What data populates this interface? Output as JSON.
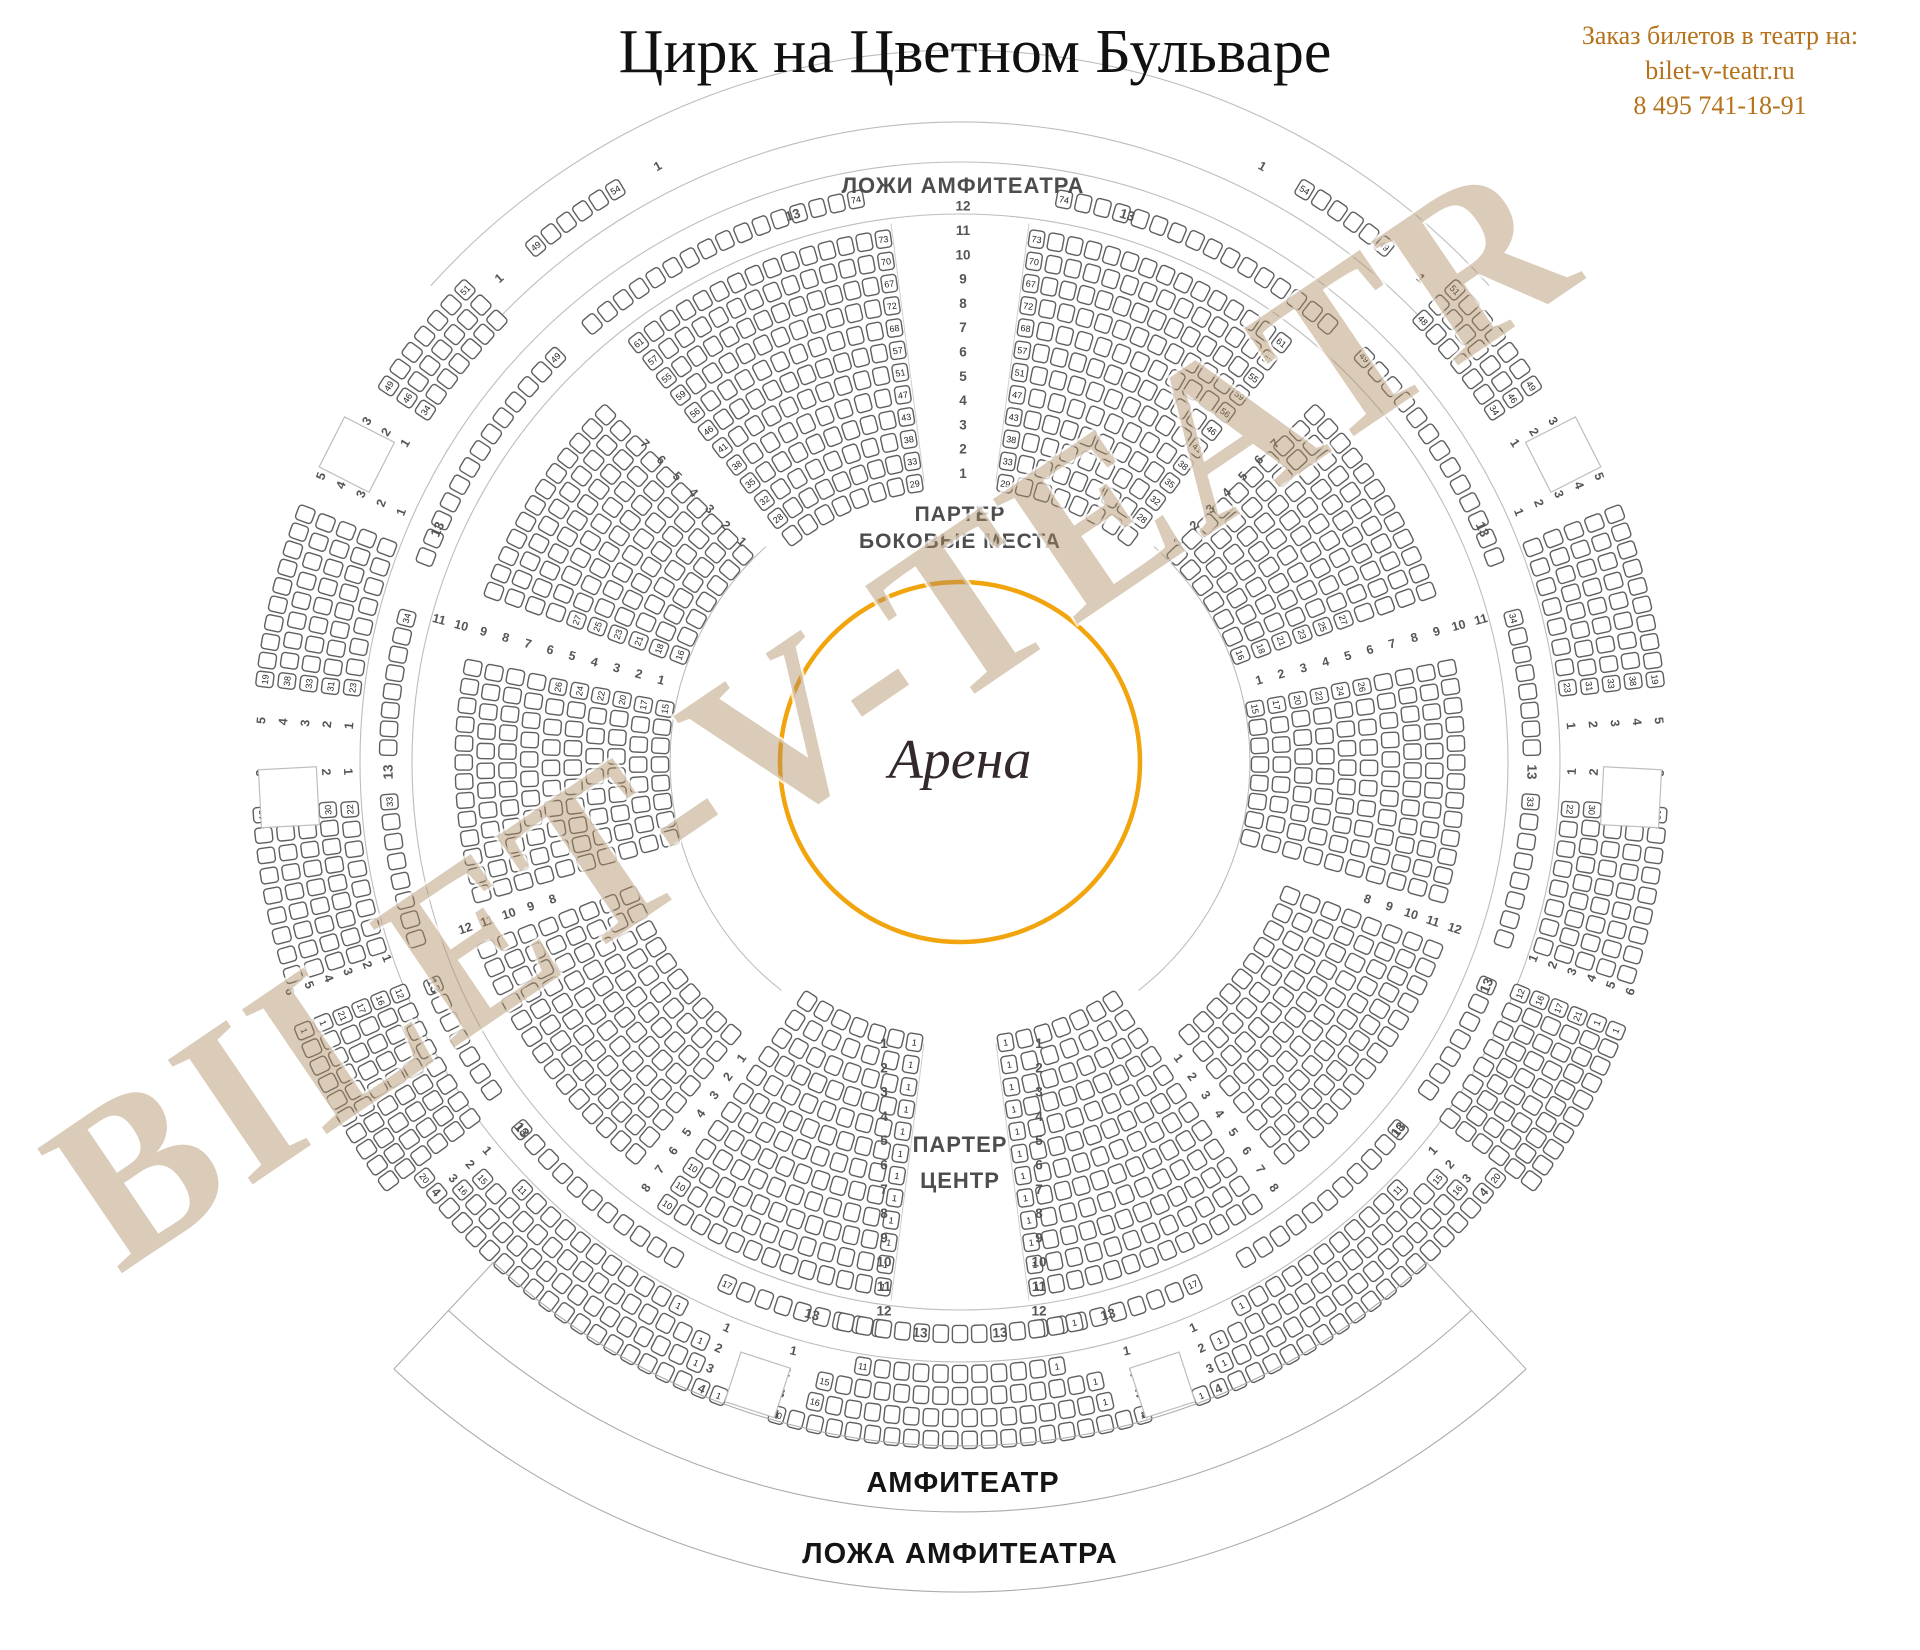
{
  "header": {
    "title": "Цирк на Цветном Бульваре",
    "contact": {
      "line1": "Заказ билетов в театр на:",
      "line2": "bilet-v-teatr.ru",
      "line3": "8 495 741-18-91"
    }
  },
  "watermark": {
    "text": "BILET-V-TEATR"
  },
  "arena": {
    "label": "Арена"
  },
  "labels": {
    "lozhi_amfiteatra": "ЛОЖИ АМФИТЕАТРА",
    "parter": "ПАРТЕР",
    "bokovye": "БОКОВЫЕ МЕСТА",
    "centr": "ЦЕНТР",
    "amfiteatr": "АМФИТЕАТР",
    "lozha_amfiteatra": "ЛОЖА АМФИТЕАТРА"
  },
  "colors": {
    "accent_orange": "#F2A40D",
    "contact_text": "#B5721B",
    "label_gray": "#4D4D4D",
    "dark_text": "#141414",
    "seat_stroke": "#5F5F5F",
    "seat_number": "#222222",
    "arc_line": "#BDBDBD",
    "row_number": "#555555",
    "watermark_fill": "rgba(176,140,99,0.45)",
    "watermark_halo": "rgba(255,255,255,0.75)",
    "arena_text": "#33282A"
  },
  "map": {
    "center": {
      "x": 960,
      "y": 762
    },
    "arena_r": 180,
    "seat_pitch": 19.5,
    "inner_arcs": [
      {
        "r": 290,
        "a0": 42,
        "a1": 142
      },
      {
        "r": 290,
        "a0": -142,
        "a1": -42
      }
    ],
    "ring_circles": [
      548,
      600
    ],
    "top_arcs": [
      {
        "r": 640,
        "a0": -46,
        "a1": 46
      },
      {
        "r": 712,
        "a0": -48,
        "a1": 48
      }
    ],
    "aisle_lines": [
      {
        "a": -7.3,
        "r0": 282,
        "r1": 543
      },
      {
        "a": 7.3,
        "r0": 282,
        "r1": 543
      },
      {
        "a": 172.7,
        "r0": 284,
        "r1": 543
      },
      {
        "a": 187.3,
        "r0": 284,
        "r1": 543
      }
    ],
    "parter_sectors": [
      {
        "id": "top-center-left",
        "a0": -38.5,
        "a1": -7.3,
        "r0": 282,
        "dr": 22.4,
        "rows": 12,
        "la0": [
          null,
          28,
          32,
          35,
          38,
          41,
          46,
          56,
          59,
          55,
          57,
          61
        ],
        "la1": [
          29,
          33,
          38,
          43,
          47,
          51,
          57,
          68,
          72,
          67,
          70,
          73
        ]
      },
      {
        "id": "top-center-right",
        "a0": 7.3,
        "a1": 38.5,
        "r0": 282,
        "dr": 22.4,
        "rows": 12,
        "la0": [
          29,
          33,
          38,
          43,
          47,
          51,
          57,
          68,
          72,
          67,
          70,
          73
        ],
        "la1": [
          null,
          28,
          32,
          35,
          38,
          41,
          46,
          56,
          59,
          55,
          57,
          61
        ]
      },
      {
        "id": "right-upper",
        "a0": 44.5,
        "a1": 71,
        "r0": 300,
        "dr": 21.8,
        "rows": 10,
        "la1": [
          16,
          18,
          21,
          23,
          25,
          27,
          null,
          null,
          null,
          null
        ]
      },
      {
        "id": "right-lower",
        "a0": 78,
        "a1": 106.5,
        "r0": 300,
        "dr": 21.8,
        "rows": 10,
        "la0": [
          15,
          17,
          20,
          22,
          24,
          26,
          null,
          null,
          null,
          null
        ]
      },
      {
        "id": "bottom-right-diag",
        "a0": 110.5,
        "a1": 141.5,
        "r0": 356,
        "dr": 21.8,
        "rows": 8
      },
      {
        "id": "bottom-center-right",
        "a0": 145.5,
        "a1": 172.7,
        "r0": 284,
        "dr": 22.4,
        "rows": 12,
        "la1": [
          1,
          1,
          1,
          1,
          1,
          1,
          1,
          1,
          1,
          1,
          1,
          1
        ]
      },
      {
        "id": "bottom-center-left",
        "a0": 187.3,
        "a1": 214.5,
        "r0": 284,
        "dr": 22.4,
        "rows": 12,
        "la0": [
          1,
          1,
          1,
          1,
          1,
          1,
          1,
          1,
          1,
          1,
          1,
          1
        ],
        "la1": [
          null,
          null,
          null,
          null,
          null,
          null,
          null,
          null,
          null,
          10,
          10,
          10
        ]
      },
      {
        "id": "bottom-left-diag",
        "a0": -141.5,
        "a1": -110.5,
        "r0": 356,
        "dr": 21.8,
        "rows": 8
      },
      {
        "id": "left-lower",
        "a0": -106.5,
        "a1": -78,
        "r0": 300,
        "dr": 21.8,
        "rows": 10,
        "la1": [
          15,
          17,
          20,
          22,
          24,
          26,
          null,
          null,
          null,
          null
        ]
      },
      {
        "id": "left-upper",
        "a0": -71,
        "a1": -44.5,
        "r0": 300,
        "dr": 21.8,
        "rows": 10,
        "la0": [
          16,
          18,
          21,
          23,
          25,
          27,
          null,
          null,
          null,
          null
        ]
      }
    ],
    "row13": {
      "r": 572,
      "label": "13",
      "segments": [
        [
          -41,
          -9.5,
          null,
          74
        ],
        [
          9.5,
          41,
          74,
          null
        ],
        [
          -70,
          -44,
          null,
          49
        ],
        [
          44,
          70,
          49,
          null
        ],
        [
          -89.5,
          -74.5,
          null,
          34
        ],
        [
          74.5,
          89.5,
          34,
          null
        ],
        [
          -109,
          -93,
          null,
          33
        ],
        [
          93,
          109,
          33,
          null
        ],
        [
          -126,
          -112,
          null,
          null
        ],
        [
          112,
          126,
          null,
          null
        ],
        [
          -151,
          -129,
          null,
          18
        ],
        [
          129,
          151,
          18,
          null
        ],
        [
          -173,
          -155,
          null,
          17
        ],
        [
          155,
          173,
          17,
          null
        ],
        [
          167.5,
          192.5,
          1,
          null
        ]
      ],
      "label_angles": [
        -176,
        -165,
        -130,
        -113,
        -91,
        -66,
        -17,
        17,
        66,
        91,
        113,
        130,
        165,
        176
      ]
    },
    "ring_sectors": [
      {
        "id": "lozhi-left",
        "a0": -41,
        "a1": -29.5,
        "r0": 668,
        "dr": 22,
        "rows": 1,
        "counts": [
          6
        ],
        "la0": [
          49
        ],
        "la1": [
          54
        ],
        "rn0": [
          "1"
        ],
        "rn1": [
          "1"
        ]
      },
      {
        "id": "lozhi-right",
        "a0": 29.5,
        "a1": 41,
        "r0": 668,
        "dr": 22,
        "rows": 1,
        "counts": [
          6
        ],
        "la0": [
          54
        ],
        "la1": [
          49
        ],
        "rn0": [
          "1"
        ],
        "rn1": [
          "1"
        ]
      },
      {
        "id": "ring-3row-left",
        "a0": -57.5,
        "a1": -45.5,
        "r0": 640,
        "dr": 22,
        "rows": 3,
        "la0": [
          34,
          46,
          49
        ],
        "la1": [
          null,
          null,
          51
        ],
        "rn0": [
          1,
          2,
          3
        ]
      },
      {
        "id": "ring-3row-right",
        "a0": 45.5,
        "a1": 57.5,
        "r0": 640,
        "dr": 22,
        "rows": 3,
        "la1": [
          34,
          46,
          49
        ],
        "la0": [
          48,
          null,
          51
        ],
        "rn1": [
          1,
          2,
          3
        ]
      },
      {
        "id": "ring-5row-left-upper",
        "a0": -84,
        "a1": -68.5,
        "r0": 612,
        "dr": 22,
        "rows": 5,
        "la0": [
          23,
          31,
          33,
          38,
          19
        ],
        "rn0": [
          1,
          2,
          3,
          4,
          5
        ],
        "rn1": [
          1,
          2,
          3,
          4,
          5
        ]
      },
      {
        "id": "ring-5row-right-upper",
        "a0": 68.5,
        "a1": 84,
        "r0": 612,
        "dr": 22,
        "rows": 5,
        "la1": [
          23,
          31,
          33,
          38,
          19
        ],
        "rn1": [
          1,
          2,
          3,
          4,
          5
        ],
        "rn0": [
          1,
          2,
          3,
          4,
          5
        ]
      },
      {
        "id": "ring-5row-left-lower",
        "a0": -108.5,
        "a1": -93.5,
        "r0": 612,
        "dr": 22,
        "rows": 5,
        "la1": [
          22,
          30,
          32,
          37,
          18
        ],
        "rn1": [
          1,
          2,
          3,
          4,
          5
        ]
      },
      {
        "id": "ring-5row-right-lower",
        "a0": 93.5,
        "a1": 108.5,
        "r0": 612,
        "dr": 22,
        "rows": 5,
        "la0": [
          22,
          30,
          32,
          37,
          18
        ],
        "rn0": [
          1,
          2,
          3,
          4,
          5
        ]
      },
      {
        "id": "ring-6row-left",
        "a0": -127,
        "a1": -111.5,
        "r0": 606,
        "dr": 20.5,
        "rows": 6,
        "la1": [
          12,
          16,
          17,
          21,
          1,
          1
        ],
        "rn1": [
          1,
          2,
          3,
          4,
          5,
          6
        ]
      },
      {
        "id": "ring-6row-right",
        "a0": 111.5,
        "a1": 127,
        "r0": 606,
        "dr": 20.5,
        "rows": 6,
        "la0": [
          12,
          16,
          17,
          21,
          1,
          1
        ],
        "rn0": [
          1,
          2,
          3,
          4,
          5,
          6
        ]
      },
      {
        "id": "amfiteatr-bottom-far-left",
        "a0": -155,
        "a1": -132,
        "r0": 612,
        "dr": 22,
        "rows": 4,
        "counts": [
          11,
          15,
          16,
          20
        ],
        "la0": [
          1,
          1,
          1,
          1
        ],
        "la1": [
          11,
          15,
          16,
          20
        ],
        "rn0": [
          1,
          2,
          3,
          4
        ],
        "rn1": [
          1,
          2,
          3,
          4
        ]
      },
      {
        "id": "amfiteatr-bottom-far-right",
        "a0": 132,
        "a1": 155,
        "r0": 612,
        "dr": 22,
        "rows": 4,
        "counts": [
          11,
          15,
          16,
          20
        ],
        "la1": [
          1,
          1,
          1,
          1
        ],
        "la0": [
          11,
          15,
          16,
          20
        ],
        "rn0": [
          1,
          2,
          3,
          4
        ],
        "rn1": [
          1,
          2,
          3,
          4
        ]
      },
      {
        "id": "amfiteatr-bottom-center",
        "a0": 166.8,
        "a1": 193.2,
        "r0": 612,
        "dr": 22,
        "rows": 4,
        "counts": [
          11,
          15,
          16,
          20
        ],
        "la0": [
          1,
          1,
          1,
          1
        ],
        "la1": [
          11,
          15,
          16,
          20
        ],
        "rn0": [
          1,
          2,
          3,
          4
        ],
        "rn1": [
          1,
          2,
          3,
          4
        ]
      }
    ],
    "entrance_boxes": [
      {
        "a": -63,
        "r": 677,
        "size": 56
      },
      {
        "a": 63,
        "r": 677,
        "size": 56
      },
      {
        "a": -93,
        "r": 672,
        "size": 58
      },
      {
        "a": 93,
        "r": 672,
        "size": 58
      },
      {
        "a": -162,
        "r": 655,
        "size": 52
      },
      {
        "a": 162,
        "r": 655,
        "size": 52
      }
    ],
    "bottom_bands": {
      "arc_radii": [
        684,
        750,
        830
      ],
      "a0": 137,
      "a1": 223,
      "amfiteatr_label_pos": {
        "x": 963,
        "y": 1492
      },
      "lozha_label_pos": {
        "x": 960,
        "y": 1563
      }
    },
    "aisle_numbers": {
      "top_column": {
        "x": 963,
        "y0": 478,
        "dy": -24.3,
        "values": [
          1,
          2,
          3,
          4,
          5,
          6,
          7,
          8,
          9,
          10,
          11,
          12
        ]
      },
      "bottom_left": {
        "x": 884,
        "y0": 1048,
        "dy": 24.3,
        "values": [
          1,
          2,
          3,
          4,
          5,
          6,
          7,
          8,
          9,
          10,
          11,
          12
        ]
      },
      "bottom_right": {
        "x": 1039,
        "y0": 1048,
        "dy": 24.3,
        "values": [
          1,
          2,
          3,
          4,
          5,
          6,
          7,
          8,
          9,
          10,
          11,
          12
        ]
      },
      "radial": [
        {
          "angle": -44.7,
          "r0": 310,
          "dr": 23,
          "values": [
            1,
            2,
            3,
            4,
            5,
            6,
            7
          ]
        },
        {
          "angle": 44.7,
          "r0": 310,
          "dr": 23,
          "values": [
            1,
            2,
            3,
            4,
            5,
            6,
            7
          ]
        },
        {
          "angle": -74.7,
          "r0": 310,
          "dr": 23,
          "values": [
            1,
            2,
            3,
            4,
            5,
            6,
            7,
            8,
            9,
            10,
            11
          ]
        },
        {
          "angle": 74.7,
          "r0": 310,
          "dr": 23,
          "values": [
            1,
            2,
            3,
            4,
            5,
            6,
            7,
            8,
            9,
            10,
            11
          ]
        },
        {
          "angle": -108.6,
          "r0": 430,
          "dr": 23,
          "values": [
            8,
            9,
            10,
            11,
            12
          ]
        },
        {
          "angle": 108.6,
          "r0": 430,
          "dr": 23,
          "values": [
            8,
            9,
            10,
            11,
            12
          ]
        },
        {
          "angle": -143.6,
          "r0": 368,
          "dr": 23,
          "values": [
            1,
            2,
            3,
            4,
            5,
            6,
            7,
            8
          ]
        },
        {
          "angle": 143.6,
          "r0": 368,
          "dr": 23,
          "values": [
            1,
            2,
            3,
            4,
            5,
            6,
            7,
            8
          ]
        }
      ]
    }
  }
}
